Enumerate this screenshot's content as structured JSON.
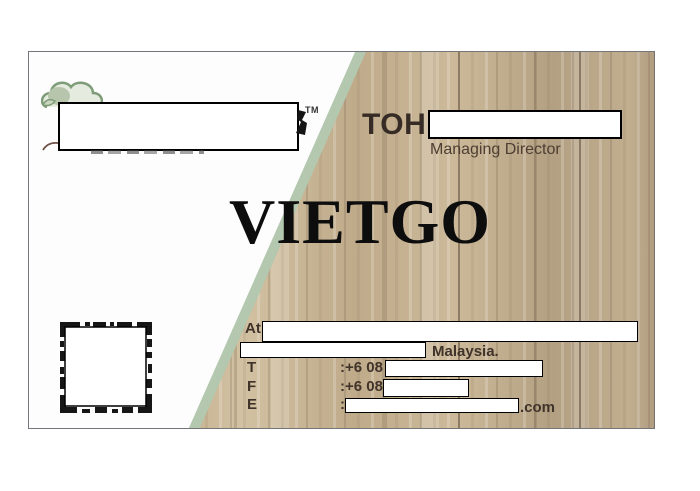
{
  "card": {
    "watermark": "VIETGO",
    "logo": {
      "tm": "TM"
    },
    "person": {
      "surname": "TOH",
      "title": "Managing Director"
    },
    "contact": {
      "address_label": "At",
      "country": "Malaysia.",
      "tel_label": "T",
      "tel_value_prefix": ":+6 08",
      "fax_label": "F",
      "fax_value_prefix": ":+6 08",
      "email_label": "E",
      "email_colon": ":",
      "email_domain_suffix": ".com"
    }
  },
  "colors": {
    "accent_green": "#b3c8ae",
    "wood_base": "#c3af8f",
    "text_brown": "#40332a",
    "watermark_black": "#0d0d0e",
    "logo_green": "#7e9c78"
  }
}
